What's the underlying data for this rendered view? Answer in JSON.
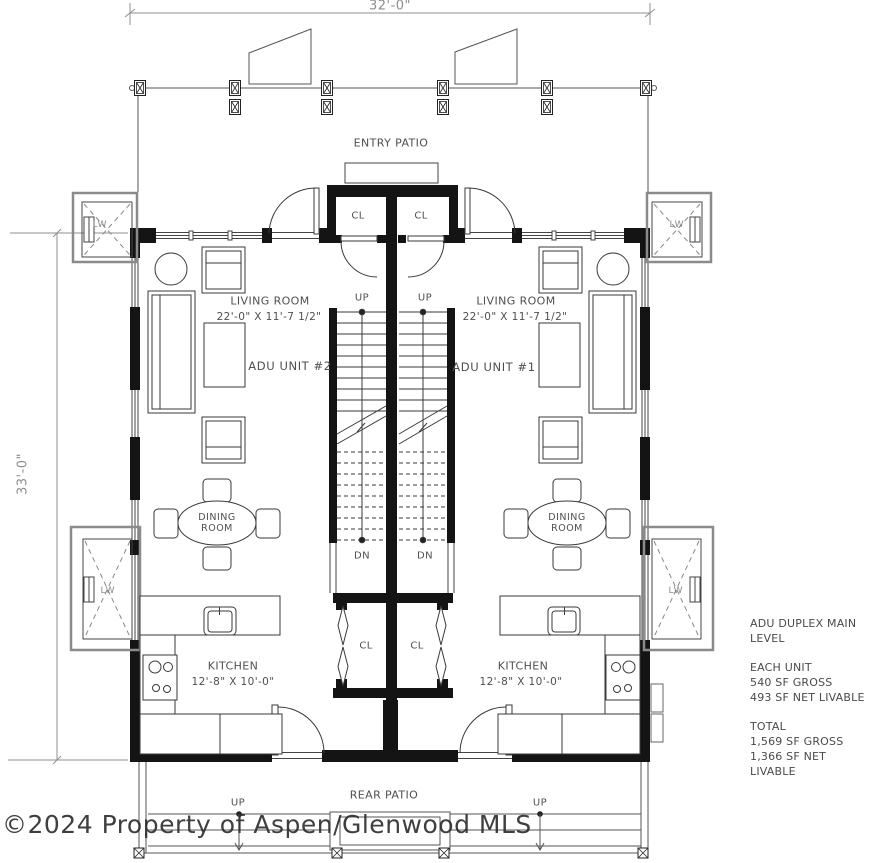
{
  "dimensions": {
    "overall_width": "32'-0\"",
    "overall_height": "33'-0\""
  },
  "site": {
    "entry_patio": "ENTRY PATIO",
    "rear_patio": "REAR PATIO"
  },
  "labels": {
    "closet": "CL",
    "up": "UP",
    "down": "DN",
    "window_well": "LW"
  },
  "unit2": {
    "name": "ADU UNIT #2",
    "living_room": {
      "name": "LIVING ROOM",
      "dimensions": "22'-0\" X 11'-7 1/2\""
    },
    "dining_room": {
      "line1": "DINING",
      "line2": "ROOM"
    },
    "kitchen": {
      "name": "KITCHEN",
      "dimensions": "12'-8\" X 10'-0\""
    }
  },
  "unit1": {
    "name": "ADU UNIT #1",
    "living_room": {
      "name": "LIVING ROOM",
      "dimensions": "22'-0\" X 11'-7 1/2\""
    },
    "dining_room": {
      "line1": "DINING",
      "line2": "ROOM"
    },
    "kitchen": {
      "name": "KITCHEN",
      "dimensions": "12'-8\" X 10'-0\""
    }
  },
  "notes": {
    "title_line1": "ADU DUPLEX MAIN",
    "title_line2": "LEVEL",
    "each_unit": {
      "header": "EACH UNIT",
      "gross": "540 SF GROSS",
      "net": "493 SF NET LIVABLE"
    },
    "total": {
      "header": "TOTAL",
      "gross": "1,569 SF GROSS",
      "net": "1,366 SF NET LIVABLE"
    }
  },
  "watermark": "©2024 Property of Aspen/Glenwood MLS",
  "colors": {
    "wall": "#141414",
    "line": "#3a3a3a",
    "dim": "#8e8e8e",
    "text": "#4f4f4f",
    "watermark": "#2f2f2f"
  }
}
